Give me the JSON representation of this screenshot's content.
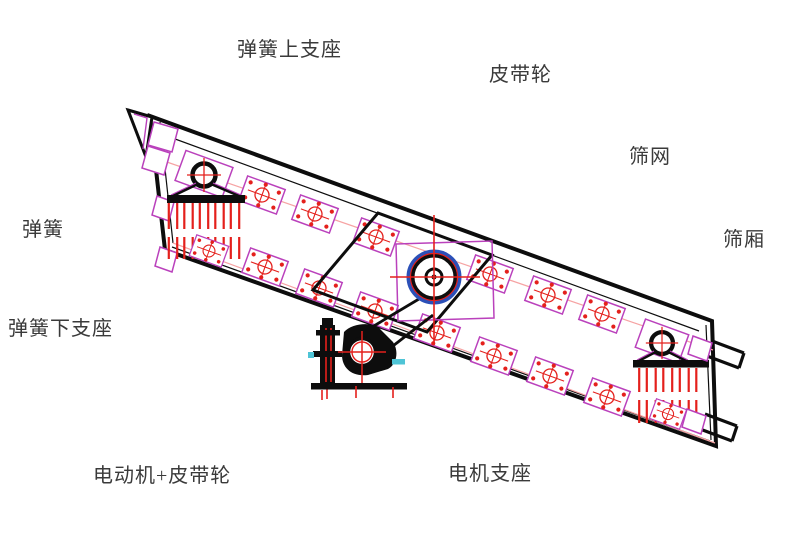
{
  "page": {
    "background": "#ffffff",
    "kind": "vibrating-screen technical diagram"
  },
  "colors": {
    "label_text": "#3a3a3a",
    "leader": "#5bc8dc",
    "outline": "#0d0d0d",
    "red": "#e4201c",
    "magenta": "#ba41bc",
    "pink": "#f6a3a3",
    "blue": "#2b50b8",
    "cyan": "#4ec4d6"
  },
  "labels": {
    "spring_upper_support": "弹簧上支座",
    "belt_pulley": "皮带轮",
    "screen_mesh": "筛网",
    "spring": "弹簧",
    "screen_box": "筛厢",
    "spring_lower_support": "弹簧下支座",
    "motor_belt_pulley": "电动机+皮带轮",
    "motor_support": "电机支座"
  }
}
